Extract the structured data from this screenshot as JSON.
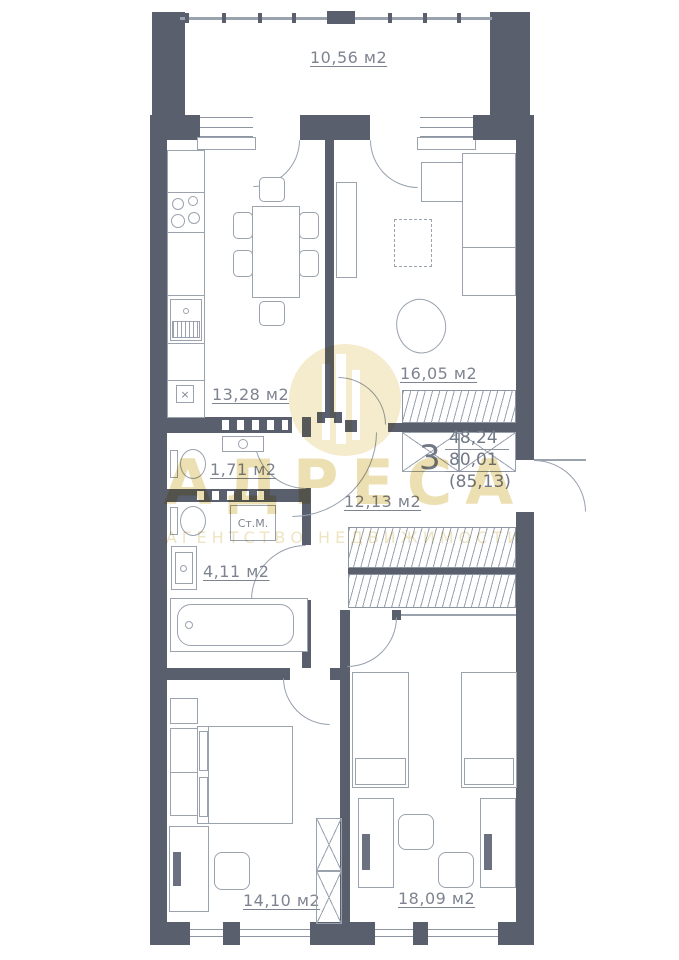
{
  "unit": {
    "rooms": "3",
    "living_area": "48,24",
    "floor_area": "80,01",
    "total_area": "(85,13)"
  },
  "rooms": {
    "balcony": {
      "area": "10,56 м2"
    },
    "kitchen": {
      "area": "13,28 м2"
    },
    "living_room": {
      "area": "16,05 м2"
    },
    "wc": {
      "area": "1,71 м2"
    },
    "hallway": {
      "area": "12,13 м2"
    },
    "bathroom": {
      "area": "4,11 м2"
    },
    "bedroom_1": {
      "area": "14,10 м2"
    },
    "bedroom_2": {
      "area": "18,09 м2"
    }
  },
  "fixtures": {
    "washing_machine": "Ст.М.",
    "kitchen_unit_mark": "×"
  },
  "watermark": {
    "brand": "АДРЕСА",
    "tagline": "АГЕНТСТВО НЕДВИЖИМОСТИ"
  },
  "colors": {
    "wall": "#5a5f6d",
    "furniture_line": "#9aa2ae",
    "label_text": "#7d8490",
    "watermark": "#ecdfb2"
  }
}
